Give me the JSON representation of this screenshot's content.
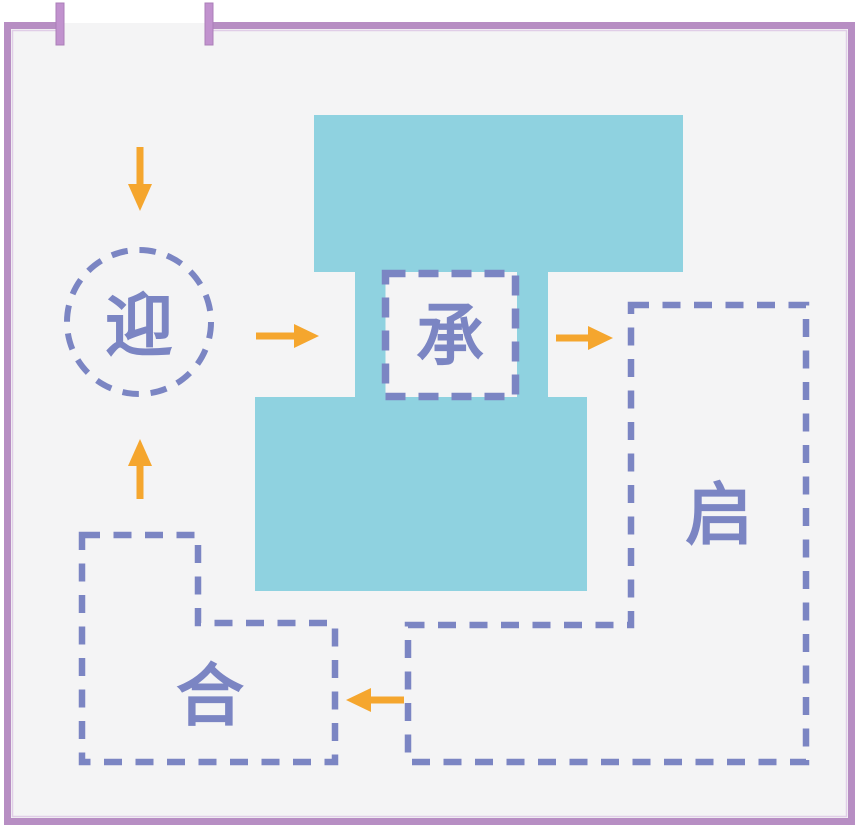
{
  "diagram": {
    "type": "architectural-circulation-concept",
    "entrance": {
      "type": "door-opening",
      "position": "top-left"
    },
    "nodes": [
      {
        "id": "ying",
        "label": "迎",
        "shape": "dashed-circle"
      },
      {
        "id": "cheng",
        "label": "承",
        "shape": "dashed-square"
      },
      {
        "id": "qi",
        "label": "启",
        "shape": "dashed-l-rectangle"
      },
      {
        "id": "he",
        "label": "合",
        "shape": "dashed-step-rectangle"
      }
    ],
    "solid_mass": {
      "shape": "i-beam-block",
      "color": "#8fd2e0"
    },
    "arrows": [
      {
        "id": "entry-down",
        "direction": "down"
      },
      {
        "id": "ying-to-cheng",
        "direction": "right"
      },
      {
        "id": "cheng-to-qi",
        "direction": "right"
      },
      {
        "id": "qi-to-he",
        "direction": "left"
      },
      {
        "id": "he-to-ying",
        "direction": "up"
      }
    ],
    "colors": {
      "frame": "#b78ec3",
      "frame_tick": "#c192ce",
      "background": "#f4f4f5",
      "mass_fill": "#8fd2e0",
      "dashed_stroke": "#7b85c3",
      "arrow": "#f5a62e"
    }
  }
}
